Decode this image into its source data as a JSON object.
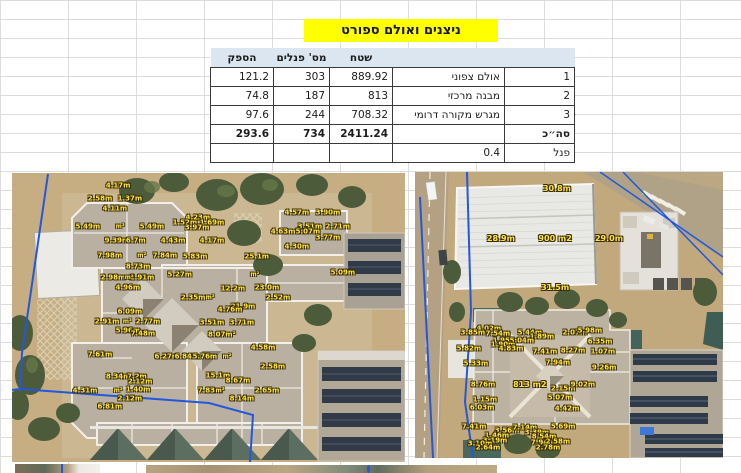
{
  "title": "ניצנים ואולם ספורט",
  "table": {
    "headers": {
      "power": "הספק",
      "panels": "מס' פנלים",
      "area": "שטח"
    },
    "rows": [
      {
        "num": "1",
        "label": "אולם צפוני",
        "area": "889.92",
        "panels": "303",
        "power": "121.2"
      },
      {
        "num": "2",
        "label": "מבנה מרכזי",
        "area": "813",
        "panels": "187",
        "power": "74.8"
      },
      {
        "num": "3",
        "label": "מגרש מקורה דרומי",
        "area": "708.32",
        "panels": "244",
        "power": "97.6"
      }
    ],
    "total": {
      "num": "סה״כ",
      "label": "",
      "area": "2411.24",
      "panels": "734",
      "power": "293.6"
    },
    "panel": {
      "num": "פנל",
      "value": "0.4"
    }
  },
  "colors": {
    "title_highlight": "#ffff00",
    "header_fill": "#dce6f1",
    "measurement_label": "#ffe43c",
    "boundary_line": "#2158dc"
  },
  "images": {
    "left": {
      "labels": [
        {
          "t": "4.17m",
          "x": 27.0,
          "y": 4.5
        },
        {
          "t": "2.58m",
          "x": 22.4,
          "y": 9.0
        },
        {
          "t": "1.37m",
          "x": 30.0,
          "y": 9.0
        },
        {
          "t": "4.11m",
          "x": 26.2,
          "y": 12.5
        },
        {
          "t": "5.49m",
          "x": 19.3,
          "y": 18.7
        },
        {
          "t": "5.49m",
          "x": 35.6,
          "y": 18.7
        },
        {
          "t": "9.39m",
          "x": 26.7,
          "y": 23.5
        },
        {
          "t": "6.7m",
          "x": 31.5,
          "y": 23.5
        },
        {
          "t": "4.23m",
          "x": 47.3,
          "y": 15.6
        },
        {
          "t": "1.52m",
          "x": 44.0,
          "y": 17.3
        },
        {
          "t": "1.69m",
          "x": 50.9,
          "y": 17.3
        },
        {
          "t": "3.97m",
          "x": 47.1,
          "y": 19.0
        },
        {
          "t": "4.43m",
          "x": 41.0,
          "y": 23.5
        },
        {
          "t": "4.17m",
          "x": 50.9,
          "y": 23.5
        },
        {
          "t": "7.98m",
          "x": 24.9,
          "y": 28.7
        },
        {
          "t": "7.84m",
          "x": 38.9,
          "y": 28.7
        },
        {
          "t": "5.83m",
          "x": 46.6,
          "y": 29.1
        },
        {
          "t": "8.73m",
          "x": 32.1,
          "y": 32.5
        },
        {
          "t": "2.98m",
          "x": 25.7,
          "y": 36.3
        },
        {
          "t": "2.91m",
          "x": 33.1,
          "y": 36.3
        },
        {
          "t": "4.96m",
          "x": 29.5,
          "y": 39.8
        },
        {
          "t": "5.27m",
          "x": 42.7,
          "y": 35.3
        },
        {
          "t": "4.57m",
          "x": 72.5,
          "y": 13.8
        },
        {
          "t": "3.90m",
          "x": 80.4,
          "y": 13.8
        },
        {
          "t": "3.51m",
          "x": 75.8,
          "y": 18.7
        },
        {
          "t": "2.71m",
          "x": 82.9,
          "y": 18.7
        },
        {
          "t": "4.63m",
          "x": 69.0,
          "y": 20.4
        },
        {
          "t": "5.07m",
          "x": 75.3,
          "y": 20.4
        },
        {
          "t": "3.77m",
          "x": 80.4,
          "y": 22.5
        },
        {
          "t": "4.30m",
          "x": 72.5,
          "y": 25.6
        },
        {
          "t": "25.1m",
          "x": 62.3,
          "y": 29.1
        },
        {
          "t": "5.09m",
          "x": 84.2,
          "y": 34.6
        },
        {
          "t": "12.2m",
          "x": 56.2,
          "y": 40.1
        },
        {
          "t": "23.0m",
          "x": 64.9,
          "y": 39.8
        },
        {
          "t": "2.35m",
          "x": 46.1,
          "y": 43.3
        },
        {
          "t": "2.52m",
          "x": 67.7,
          "y": 43.3
        },
        {
          "t": "21.9m",
          "x": 58.8,
          "y": 46.4
        },
        {
          "t": "4.76m",
          "x": 55.5,
          "y": 47.4
        },
        {
          "t": "6.09m",
          "x": 30.0,
          "y": 48.1
        },
        {
          "t": "2.91m",
          "x": 24.2,
          "y": 51.6
        },
        {
          "t": "2.77m",
          "x": 34.6,
          "y": 51.6
        },
        {
          "t": "3.51m",
          "x": 50.9,
          "y": 51.9
        },
        {
          "t": "3.71m",
          "x": 58.5,
          "y": 51.9
        },
        {
          "t": "5.96m",
          "x": 29.5,
          "y": 54.7
        },
        {
          "t": "7.48m",
          "x": 33.3,
          "y": 55.7
        },
        {
          "t": "8.07m²",
          "x": 53.4,
          "y": 56.1
        },
        {
          "t": "4.58m",
          "x": 63.9,
          "y": 60.6
        },
        {
          "t": "7.61m",
          "x": 22.4,
          "y": 63.0
        },
        {
          "t": "6.27m",
          "x": 39.4,
          "y": 63.7
        },
        {
          "t": "6.84m",
          "x": 44.5,
          "y": 63.7
        },
        {
          "t": "5.76m",
          "x": 49.1,
          "y": 63.7
        },
        {
          "t": "2.58m",
          "x": 66.4,
          "y": 67.1
        },
        {
          "t": "8.34m",
          "x": 27.0,
          "y": 70.6
        },
        {
          "t": "7.2m",
          "x": 31.8,
          "y": 70.6
        },
        {
          "t": "15.1m",
          "x": 52.4,
          "y": 70.2
        },
        {
          "t": "2.12m",
          "x": 32.6,
          "y": 72.3
        },
        {
          "t": "8.67m",
          "x": 57.5,
          "y": 72.0
        },
        {
          "t": "4.31m",
          "x": 18.6,
          "y": 75.4
        },
        {
          "t": "1.40m",
          "x": 32.1,
          "y": 75.1
        },
        {
          "t": "7.83m",
          "x": 50.4,
          "y": 75.4
        },
        {
          "t": "2.65m",
          "x": 64.9,
          "y": 75.4
        },
        {
          "t": "2.12m",
          "x": 30.0,
          "y": 78.2
        },
        {
          "t": "8.14m",
          "x": 58.5,
          "y": 78.2
        },
        {
          "t": "6.81m",
          "x": 24.9,
          "y": 81.0
        },
        {
          "t": "m²",
          "x": 27.5,
          "y": 18.7,
          "tiny": true
        },
        {
          "t": "m²",
          "x": 33.0,
          "y": 28.7,
          "tiny": true
        },
        {
          "t": "m²",
          "x": 29.8,
          "y": 36.3,
          "tiny": true
        },
        {
          "t": "m²",
          "x": 29.3,
          "y": 51.6,
          "tiny": true
        },
        {
          "t": "m²",
          "x": 61.8,
          "y": 35.3,
          "tiny": true
        },
        {
          "t": "m²",
          "x": 50.4,
          "y": 43.3,
          "tiny": true
        },
        {
          "t": "m²",
          "x": 54.7,
          "y": 63.7,
          "tiny": true
        },
        {
          "t": "m²",
          "x": 27.0,
          "y": 75.4,
          "tiny": true
        },
        {
          "t": "m²",
          "x": 52.9,
          "y": 75.4,
          "tiny": true
        }
      ]
    },
    "right": {
      "labels": [
        {
          "t": "30.8m",
          "x": 46.1,
          "y": 5.9,
          "big": true
        },
        {
          "t": "28.9m",
          "x": 27.9,
          "y": 23.4,
          "big": true
        },
        {
          "t": "900 m2",
          "x": 45.5,
          "y": 23.4,
          "big": true
        },
        {
          "t": "29.0m",
          "x": 63.0,
          "y": 23.4,
          "big": true
        },
        {
          "t": "31.5m",
          "x": 45.5,
          "y": 40.6,
          "big": true
        },
        {
          "t": "4.02m",
          "x": 24.0,
          "y": 54.9
        },
        {
          "t": "3.85m",
          "x": 18.8,
          "y": 56.3
        },
        {
          "t": "7.54m",
          "x": 26.9,
          "y": 56.6
        },
        {
          "t": "5.44m",
          "x": 37.3,
          "y": 56.3
        },
        {
          "t": "1.89m",
          "x": 41.2,
          "y": 57.7
        },
        {
          "t": "2.07m",
          "x": 51.9,
          "y": 56.3
        },
        {
          "t": "5.98m",
          "x": 56.8,
          "y": 55.6
        },
        {
          "t": "1.95m",
          "x": 29.2,
          "y": 59.1
        },
        {
          "t": "5.04m",
          "x": 34.7,
          "y": 59.1
        },
        {
          "t": "1.90m",
          "x": 28.6,
          "y": 60.5
        },
        {
          "t": "4.83m",
          "x": 31.2,
          "y": 61.9
        },
        {
          "t": "6.35m",
          "x": 60.1,
          "y": 59.4
        },
        {
          "t": "5.82m",
          "x": 17.5,
          "y": 61.9
        },
        {
          "t": "7.41m",
          "x": 42.2,
          "y": 62.9
        },
        {
          "t": "8.27m",
          "x": 51.3,
          "y": 62.6
        },
        {
          "t": "1.07m",
          "x": 61.0,
          "y": 62.9
        },
        {
          "t": "5.33m",
          "x": 19.8,
          "y": 67.1
        },
        {
          "t": "7.94m",
          "x": 46.4,
          "y": 66.8
        },
        {
          "t": "9.26m",
          "x": 61.4,
          "y": 68.5
        },
        {
          "t": "8.76m",
          "x": 22.1,
          "y": 74.5
        },
        {
          "t": "813 m2",
          "x": 37.3,
          "y": 74.5,
          "big": true
        },
        {
          "t": "2.15m",
          "x": 48.1,
          "y": 75.9
        },
        {
          "t": "9.02m",
          "x": 54.5,
          "y": 74.5
        },
        {
          "t": "5.07m",
          "x": 47.1,
          "y": 79.0
        },
        {
          "t": "1.15m",
          "x": 22.7,
          "y": 79.7
        },
        {
          "t": "6.03m",
          "x": 21.8,
          "y": 82.5
        },
        {
          "t": "4.42m",
          "x": 49.4,
          "y": 82.9
        },
        {
          "t": "7.41m",
          "x": 19.2,
          "y": 89.2
        },
        {
          "t": "3.56m",
          "x": 29.9,
          "y": 90.6
        },
        {
          "t": "7.14m",
          "x": 35.7,
          "y": 89.5
        },
        {
          "t": "3.39m",
          "x": 39.6,
          "y": 91.3
        },
        {
          "t": "1.46m",
          "x": 26.6,
          "y": 92.3
        },
        {
          "t": "8.54m",
          "x": 41.9,
          "y": 92.7
        },
        {
          "t": "3.19m",
          "x": 26.0,
          "y": 94.1
        },
        {
          "t": "3.10m",
          "x": 21.1,
          "y": 95.1
        },
        {
          "t": "7.94m",
          "x": 41.6,
          "y": 94.8
        },
        {
          "t": "2.58m",
          "x": 46.4,
          "y": 94.4
        },
        {
          "t": "2.78m",
          "x": 43.2,
          "y": 96.5
        },
        {
          "t": "5.69m",
          "x": 48.1,
          "y": 89.2
        },
        {
          "t": "2.64m",
          "x": 23.7,
          "y": 96.5
        }
      ]
    }
  }
}
